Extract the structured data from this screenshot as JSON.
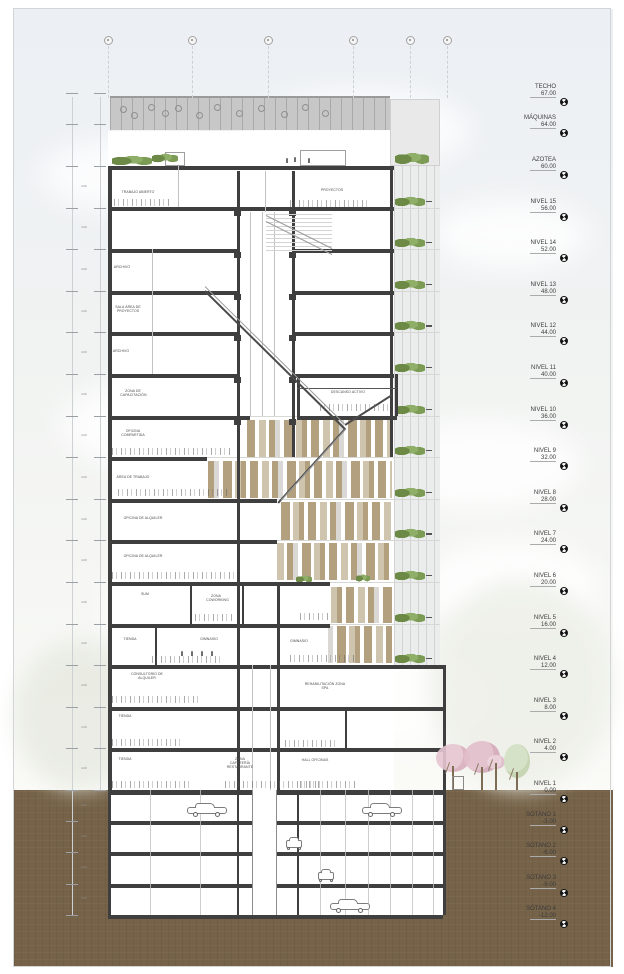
{
  "drawing": {
    "type": "architectural building section",
    "orientation": "vertical section with level annotations on the right and dimension chain on the left"
  },
  "level_markers": [
    {
      "label": "TECHO",
      "elevation": "67.00"
    },
    {
      "label": "MÁQUINAS",
      "elevation": "64.00"
    },
    {
      "label": "AZOTEA",
      "elevation": "60.00"
    },
    {
      "label": "NIVEL 15",
      "elevation": "56.00"
    },
    {
      "label": "NIVEL 14",
      "elevation": "52.00"
    },
    {
      "label": "NIVEL 13",
      "elevation": "48.00"
    },
    {
      "label": "NIVEL 12",
      "elevation": "44.00"
    },
    {
      "label": "NIVEL 11",
      "elevation": "40.00"
    },
    {
      "label": "NIVEL 10",
      "elevation": "36.00"
    },
    {
      "label": "NIVEL 9",
      "elevation": "32.00"
    },
    {
      "label": "NIVEL 8",
      "elevation": "28.00"
    },
    {
      "label": "NIVEL 7",
      "elevation": "24.00"
    },
    {
      "label": "NIVEL 6",
      "elevation": "20.00"
    },
    {
      "label": "NIVEL 5",
      "elevation": "16.00"
    },
    {
      "label": "NIVEL 4",
      "elevation": "12.00"
    },
    {
      "label": "NIVEL 3",
      "elevation": "8.00"
    },
    {
      "label": "NIVEL 2",
      "elevation": "4.00"
    },
    {
      "label": "NIVEL 1",
      "elevation": "0.00"
    },
    {
      "label": "SÓTANO 1",
      "elevation": "-3.00"
    },
    {
      "label": "SÓTANO 2",
      "elevation": "-6.00"
    },
    {
      "label": "SÓTANO 3",
      "elevation": "-9.00"
    },
    {
      "label": "SÓTANO 4",
      "elevation": "-12.00"
    }
  ],
  "room_labels": [
    {
      "text": "TRABAJO ABIERTO",
      "x": 138,
      "y": 193,
      "w": 60
    },
    {
      "text": "PROYECTOS",
      "x": 332,
      "y": 191,
      "w": 50
    },
    {
      "text": "ARCHIVO",
      "x": 122,
      "y": 268,
      "w": 40
    },
    {
      "text": "SALA ÁREA DE PROYECTOS",
      "x": 128,
      "y": 308,
      "w": 44
    },
    {
      "text": "ARCHIVO",
      "x": 121,
      "y": 352,
      "w": 40
    },
    {
      "text": "ZONA DE CAPACITACIÓN",
      "x": 133,
      "y": 392,
      "w": 44
    },
    {
      "text": "DESCANSO ACTIVO",
      "x": 348,
      "y": 393,
      "w": 60
    },
    {
      "text": "OFICINA COMPARTIDA",
      "x": 133,
      "y": 432,
      "w": 44
    },
    {
      "text": "ÁREA DE TRABAJO",
      "x": 133,
      "y": 478,
      "w": 60
    },
    {
      "text": "OFICINA DE ALQUILER",
      "x": 143,
      "y": 519,
      "w": 70
    },
    {
      "text": "OFICINA DE ALQUILER",
      "x": 143,
      "y": 557,
      "w": 70
    },
    {
      "text": "SUM",
      "x": 145,
      "y": 595,
      "w": 30
    },
    {
      "text": "ZONA COWORKING",
      "x": 216,
      "y": 597,
      "w": 34
    },
    {
      "text": "TIENDA",
      "x": 130,
      "y": 640,
      "w": 36
    },
    {
      "text": "GIMNASIO",
      "x": 209,
      "y": 640,
      "w": 40
    },
    {
      "text": "GIMNASIO",
      "x": 299,
      "y": 642,
      "w": 40
    },
    {
      "text": "CONSULTORIO DE ALQUILER",
      "x": 147,
      "y": 675,
      "w": 70
    },
    {
      "text": "REHABILITACIÓN ZONA SPA",
      "x": 325,
      "y": 685,
      "w": 70
    },
    {
      "text": "TIENDA",
      "x": 125,
      "y": 717,
      "w": 36
    },
    {
      "text": "TIENDA",
      "x": 125,
      "y": 760,
      "w": 36
    },
    {
      "text": "ZONA CAFETERÍA RESTAURANTE",
      "x": 240,
      "y": 760,
      "w": 46
    },
    {
      "text": "HALL OFICINAS",
      "x": 315,
      "y": 761,
      "w": 56
    }
  ],
  "dimensions": {
    "typical_floor": "4.00",
    "typical_basement": "3.00"
  },
  "grid_axes": {
    "count": 6
  },
  "colors": {
    "soil": "#756248",
    "slab": "#3f3f3f",
    "louver_tan": "#b2a07e",
    "louver_light_tan": "#cfc5ae",
    "louver_gray": "#d9d8d4",
    "facade_panel": "#ebecec",
    "plant_green": "#7f9c58",
    "tree_pink": "#e2becb"
  }
}
